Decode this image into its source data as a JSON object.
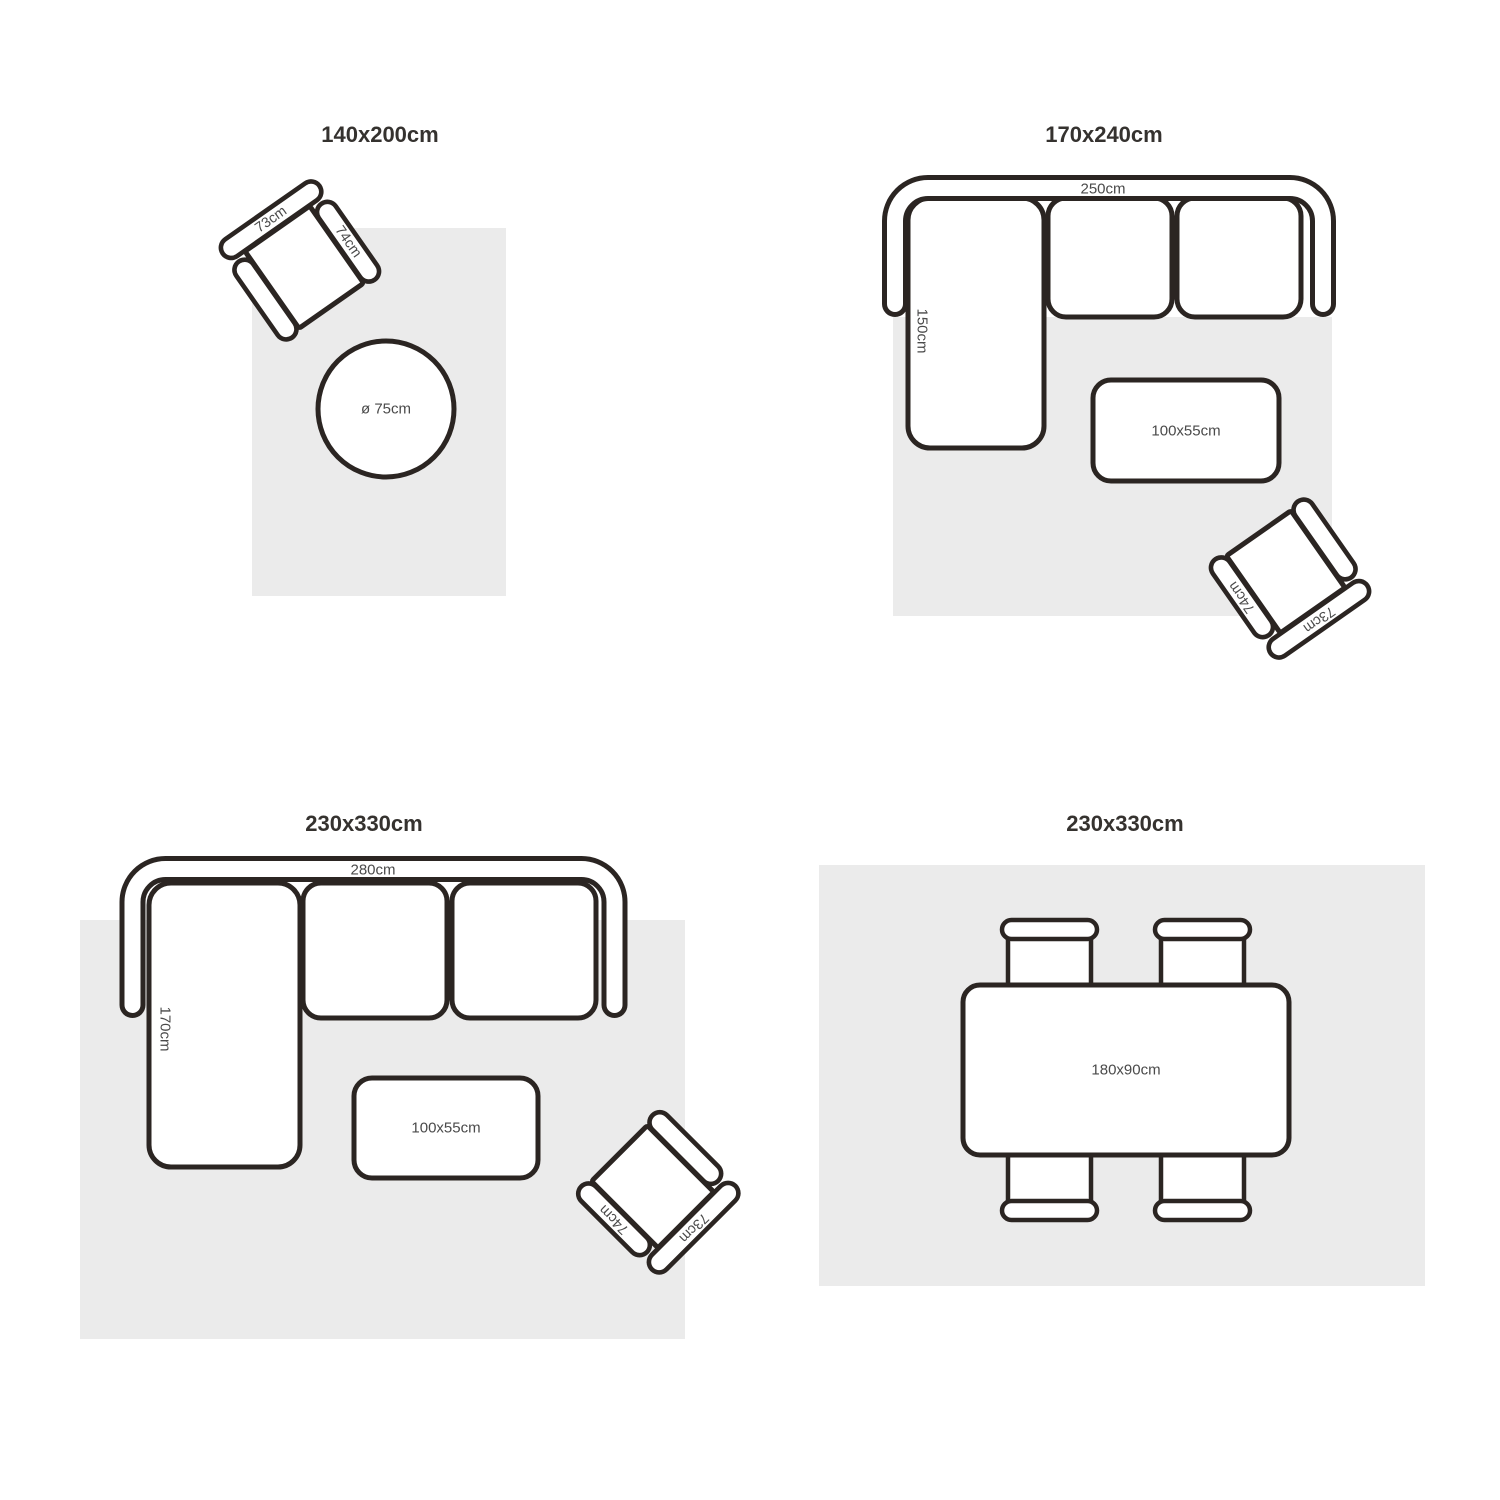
{
  "page": {
    "background": "#ffffff"
  },
  "colors": {
    "outline": "#2b2522",
    "rug_fill": "#ebebeb",
    "title_text": "#35322f",
    "label_text": "#4a4a4a"
  },
  "armchair": {
    "back_label": "73cm",
    "arm_label": "74cm"
  },
  "panels": [
    {
      "title": "140x200cm",
      "items": {
        "round_table_label": "ø 75cm"
      }
    },
    {
      "title": "170x240cm",
      "items": {
        "sofa_width_label": "250cm",
        "sofa_depth_label": "150cm",
        "coffee_table_label": "100x55cm"
      }
    },
    {
      "title": "230x330cm",
      "items": {
        "sofa_width_label": "280cm",
        "sofa_depth_label": "170cm",
        "coffee_table_label": "100x55cm"
      }
    },
    {
      "title": "230x330cm",
      "items": {
        "dining_table_label": "180x90cm"
      }
    }
  ]
}
